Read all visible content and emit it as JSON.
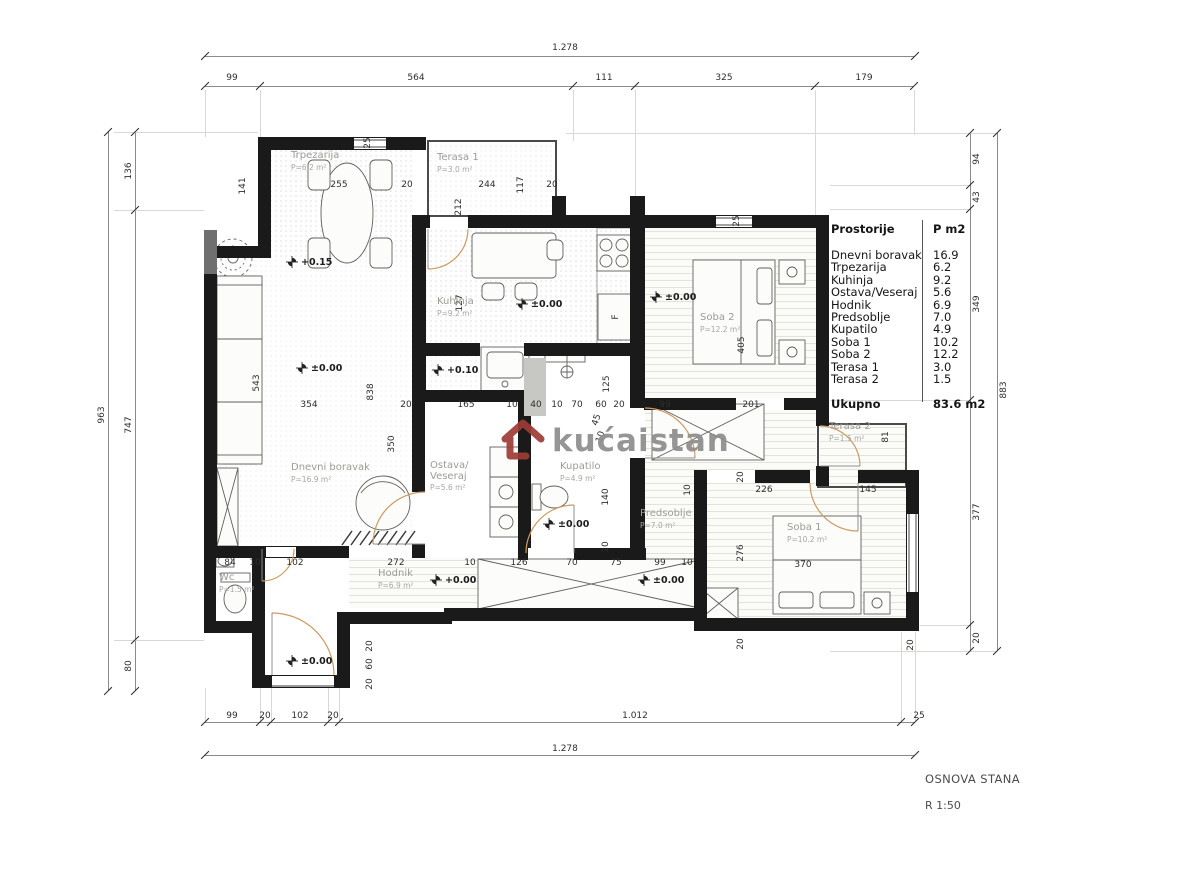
{
  "title_block": {
    "drawing_title": "OSNOVA STANA",
    "scale": "R 1:50"
  },
  "watermark": {
    "text": "kućaistan",
    "icon": "house-icon",
    "icon_color": "#9e3c36",
    "text_color": "#8d8d8d"
  },
  "legend": {
    "header": {
      "name": "Prostorije",
      "area": "P m2"
    },
    "rows": [
      {
        "name": "Dnevni boravak",
        "area": "16.9"
      },
      {
        "name": "Trpezarija",
        "area": "6.2"
      },
      {
        "name": "Kuhinja",
        "area": "9.2"
      },
      {
        "name": "Ostava/Veseraj",
        "area": "5.6"
      },
      {
        "name": "Hodnik",
        "area": "6.9"
      },
      {
        "name": "Predsoblje",
        "area": "7.0"
      },
      {
        "name": "Kupatilo",
        "area": "4.9"
      },
      {
        "name": "Soba 1",
        "area": "10.2"
      },
      {
        "name": "Soba 2",
        "area": "12.2"
      },
      {
        "name": "Terasa 1",
        "area": "3.0"
      },
      {
        "name": "Terasa 2",
        "area": "1.5"
      }
    ],
    "total": {
      "name": "Ukupno",
      "area": "83.6 m2"
    }
  },
  "rooms": [
    {
      "name": "Trpezarija",
      "area": "P=6.2 m²",
      "x": 291,
      "y": 151
    },
    {
      "name": "Terasa 1",
      "area": "P=3.0 m²",
      "x": 437,
      "y": 153
    },
    {
      "name": "Kuhinja",
      "area": "P=9.2 m²",
      "x": 437,
      "y": 297
    },
    {
      "name": "Dnevni boravak",
      "area": "P=16.9 m²",
      "x": 291,
      "y": 463
    },
    {
      "name": "Ostava/\nVeseraj",
      "area": "P=5.6 m²",
      "x": 430,
      "y": 461
    },
    {
      "name": "Kupatilo",
      "area": "P=4.9 m²",
      "x": 560,
      "y": 462
    },
    {
      "name": "Predsoblje",
      "area": "P=7.0 m²",
      "x": 640,
      "y": 509
    },
    {
      "name": "Hodnik",
      "area": "P=6.9 m²",
      "x": 378,
      "y": 569
    },
    {
      "name": "Wc",
      "area": "P=1.5 m²",
      "x": 219,
      "y": 573
    },
    {
      "name": "Soba 2",
      "area": "P=12.2 m²",
      "x": 700,
      "y": 313
    },
    {
      "name": "Terasa 2",
      "area": "P=1.5 m²",
      "x": 829,
      "y": 422
    },
    {
      "name": "Soba 1",
      "area": "P=10.2 m²",
      "x": 787,
      "y": 523
    }
  ],
  "levels": [
    {
      "t": "+0.15",
      "x": 286,
      "y": 262
    },
    {
      "t": "±0.00",
      "x": 296,
      "y": 368
    },
    {
      "t": "±0.00",
      "x": 516,
      "y": 304
    },
    {
      "t": "+0.10",
      "x": 432,
      "y": 370
    },
    {
      "t": "±0.00",
      "x": 650,
      "y": 297
    },
    {
      "t": "±0.00",
      "x": 543,
      "y": 524
    },
    {
      "t": "+0.00",
      "x": 430,
      "y": 580
    },
    {
      "t": "±0.00",
      "x": 638,
      "y": 580
    },
    {
      "t": "±0.00",
      "x": 286,
      "y": 661
    }
  ],
  "dimensions": {
    "border": [
      {
        "t": "1.278",
        "x": 565,
        "y": 48
      },
      {
        "t": "99",
        "x": 232,
        "y": 78
      },
      {
        "t": "564",
        "x": 416,
        "y": 78
      },
      {
        "t": "111",
        "x": 604,
        "y": 78
      },
      {
        "t": "325",
        "x": 724,
        "y": 78
      },
      {
        "t": "179",
        "x": 864,
        "y": 78
      },
      {
        "t": "99",
        "x": 232,
        "y": 716
      },
      {
        "t": "20",
        "x": 265,
        "y": 716
      },
      {
        "t": "102",
        "x": 300,
        "y": 716
      },
      {
        "t": "20",
        "x": 333,
        "y": 716
      },
      {
        "t": "1.012",
        "x": 635,
        "y": 716
      },
      {
        "t": "25",
        "x": 919,
        "y": 716
      },
      {
        "t": "1.278",
        "x": 565,
        "y": 749
      },
      {
        "t": "136",
        "x": 129,
        "y": 171,
        "r": 90
      },
      {
        "t": "747",
        "x": 129,
        "y": 425,
        "r": 90
      },
      {
        "t": "80",
        "x": 129,
        "y": 666,
        "r": 90
      },
      {
        "t": "963",
        "x": 102,
        "y": 415,
        "r": 90
      },
      {
        "t": "94",
        "x": 977,
        "y": 159,
        "r": 90
      },
      {
        "t": "43",
        "x": 977,
        "y": 197,
        "r": 90
      },
      {
        "t": "349",
        "x": 977,
        "y": 304,
        "r": 90
      },
      {
        "t": "377",
        "x": 977,
        "y": 512,
        "r": 90
      },
      {
        "t": "20",
        "x": 977,
        "y": 638,
        "r": 90
      },
      {
        "t": "883",
        "x": 1004,
        "y": 390,
        "r": 90
      }
    ],
    "interior": [
      {
        "t": "141",
        "x": 243,
        "y": 186,
        "r": 90
      },
      {
        "t": "255",
        "x": 339,
        "y": 185
      },
      {
        "t": "20",
        "x": 407,
        "y": 185
      },
      {
        "t": "25",
        "x": 368,
        "y": 143,
        "r": 90
      },
      {
        "t": "244",
        "x": 487,
        "y": 185
      },
      {
        "t": "117",
        "x": 521,
        "y": 185,
        "r": 90
      },
      {
        "t": "20",
        "x": 552,
        "y": 185
      },
      {
        "t": "212",
        "x": 459,
        "y": 207,
        "r": 90
      },
      {
        "t": "127",
        "x": 460,
        "y": 303,
        "r": 90
      },
      {
        "t": "25",
        "x": 737,
        "y": 221,
        "r": 90
      },
      {
        "t": "543",
        "x": 257,
        "y": 383,
        "r": 90
      },
      {
        "t": "354",
        "x": 309,
        "y": 405
      },
      {
        "t": "838",
        "x": 371,
        "y": 392,
        "r": 90
      },
      {
        "t": "20",
        "x": 406,
        "y": 405
      },
      {
        "t": "165",
        "x": 466,
        "y": 405
      },
      {
        "t": "10",
        "x": 512,
        "y": 405
      },
      {
        "t": "40",
        "x": 536,
        "y": 405
      },
      {
        "t": "10",
        "x": 557,
        "y": 405
      },
      {
        "t": "70",
        "x": 577,
        "y": 405
      },
      {
        "t": "60",
        "x": 601,
        "y": 405
      },
      {
        "t": "20",
        "x": 619,
        "y": 405
      },
      {
        "t": "99",
        "x": 665,
        "y": 405
      },
      {
        "t": "201",
        "x": 751,
        "y": 405
      },
      {
        "t": "125",
        "x": 607,
        "y": 384,
        "r": 90
      },
      {
        "t": "405",
        "x": 742,
        "y": 345,
        "r": 90
      },
      {
        "t": "350",
        "x": 392,
        "y": 444,
        "r": 90
      },
      {
        "t": "45",
        "x": 597,
        "y": 420,
        "r": 72
      },
      {
        "t": "10",
        "x": 601,
        "y": 437,
        "r": 72
      },
      {
        "t": "140",
        "x": 606,
        "y": 497,
        "r": 90
      },
      {
        "t": "10",
        "x": 606,
        "y": 547,
        "r": 90
      },
      {
        "t": "10",
        "x": 688,
        "y": 490,
        "r": 90
      },
      {
        "t": "81",
        "x": 886,
        "y": 437,
        "r": 90
      },
      {
        "t": "226",
        "x": 764,
        "y": 490
      },
      {
        "t": "145",
        "x": 868,
        "y": 490
      },
      {
        "t": "20",
        "x": 741,
        "y": 477,
        "r": 90
      },
      {
        "t": "276",
        "x": 741,
        "y": 553,
        "r": 90
      },
      {
        "t": "370",
        "x": 803,
        "y": 565
      },
      {
        "t": "20",
        "x": 741,
        "y": 644,
        "r": 90
      },
      {
        "t": "20",
        "x": 911,
        "y": 645,
        "r": 90
      },
      {
        "t": "84",
        "x": 230,
        "y": 563
      },
      {
        "t": "10",
        "x": 255,
        "y": 563
      },
      {
        "t": "102",
        "x": 295,
        "y": 563
      },
      {
        "t": "272",
        "x": 396,
        "y": 563
      },
      {
        "t": "10",
        "x": 470,
        "y": 563
      },
      {
        "t": "126",
        "x": 519,
        "y": 563
      },
      {
        "t": "70",
        "x": 572,
        "y": 563
      },
      {
        "t": "75",
        "x": 616,
        "y": 563
      },
      {
        "t": "99",
        "x": 660,
        "y": 563
      },
      {
        "t": "10",
        "x": 687,
        "y": 563
      },
      {
        "t": "20",
        "x": 370,
        "y": 646,
        "r": 90
      },
      {
        "t": "60",
        "x": 370,
        "y": 664,
        "r": 90
      },
      {
        "t": "20",
        "x": 370,
        "y": 684,
        "r": 90
      },
      {
        "t": "F",
        "x": 616,
        "y": 317,
        "r": 90
      }
    ]
  }
}
